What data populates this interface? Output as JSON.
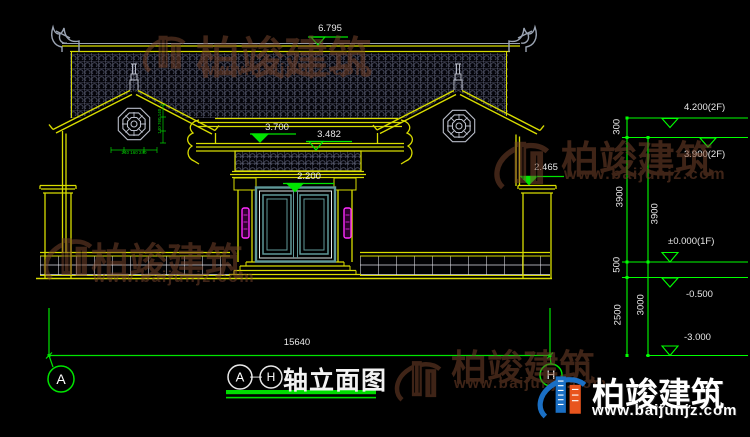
{
  "drawing": {
    "title": {
      "axis_start": "A",
      "separator": "—",
      "axis_end": "H",
      "name": "轴立面图"
    },
    "levels": {
      "ridge": "6.795",
      "main_eave": "3.700",
      "porch_eave": "3.482",
      "door_head": "2.200",
      "side_wall": "2.465"
    },
    "elevation_markers": [
      {
        "label": "4.200(2F)"
      },
      {
        "label": "3.900(2F)"
      },
      {
        "label": "±0.000(1F)"
      },
      {
        "label": "-0.500"
      },
      {
        "label": "-3.000"
      }
    ],
    "vertical_dims": {
      "col1": [
        "300",
        "3900",
        "500",
        "2500"
      ],
      "col2": [
        "3900",
        "3000"
      ]
    },
    "overall_width": "15640",
    "axis_bubbles": {
      "left": "A",
      "right": "H"
    },
    "window_dims": {
      "vertical": "140 760 140",
      "horizontal": "240 160 240"
    }
  },
  "watermark": {
    "brand": "柏竣建筑",
    "url": "www.baijunjz.com"
  },
  "logo": {
    "brand": "柏竣建筑",
    "url": "www.baijunjz.com"
  },
  "colors": {
    "background": "#000000",
    "line_yellow": "#d8dc00",
    "dim_green": "#00ff00",
    "line_green": "#00c400",
    "text_white": "#e8e8e8",
    "door_teal": "#5f9898",
    "magenta": "#ff2cff",
    "ornament_gray": "#9aa3b2",
    "watermark_red": "#7a452c",
    "logo_blue": "#1a6fc4",
    "logo_orange": "#e8551e"
  }
}
